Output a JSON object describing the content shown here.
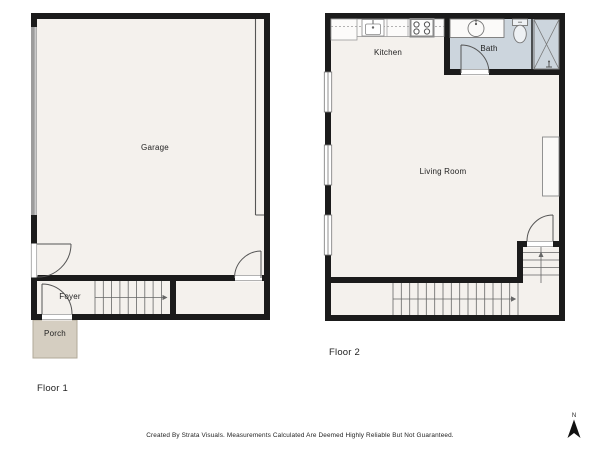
{
  "floor1": {
    "label": "Floor 1",
    "rooms": {
      "garage": "Garage",
      "foyer": "Foyer",
      "porch": "Porch"
    }
  },
  "floor2": {
    "label": "Floor 2",
    "rooms": {
      "kitchen": "Kitchen",
      "bath": "Bath",
      "living_room": "Living Room"
    }
  },
  "footer": {
    "disclaimer": "Created By Strata Visuals. Measurements Calculated Are Deemed Highly Reliable But Not Guaranteed."
  },
  "compass": {
    "north_label": "N"
  },
  "icons": {
    "fixtures": [
      "garage-door-icon",
      "door-swing-icon",
      "window-icon",
      "stairs-icon",
      "stair-direction-arrow-icon",
      "kitchen-sink-icon",
      "stove-icon",
      "bathroom-sink-icon",
      "toilet-icon",
      "shower-icon",
      "fireplace-icon",
      "north-arrow-icon"
    ]
  },
  "colors": {
    "wall": "#1b1b1b",
    "floor_fill": "#f4f1ed",
    "bath_fill": "#ccd5dd",
    "porch_fill": "#d5cec1",
    "garage_door": "#9c9c9c",
    "fixture_line": "#777777",
    "text": "#222222"
  }
}
